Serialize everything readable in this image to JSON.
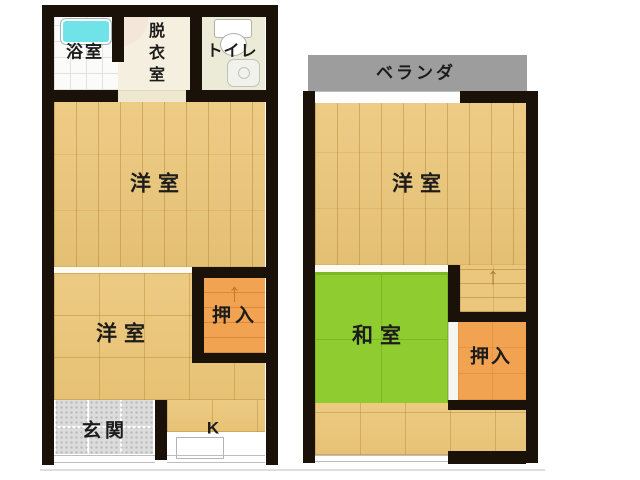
{
  "colors": {
    "wall": "#1a1208",
    "wood": "#ebc678",
    "wood_line": "#d7af5f",
    "orange": "#f1a351",
    "orange_line": "#d88a39",
    "tatami": "#8ecc2f",
    "tatami_line": "#7bb824",
    "balcony": "#9d9d9d",
    "bathtub": "#6fe3e7",
    "tile": "#dcdcdc",
    "toilet_floor": "#ebebd8",
    "dressing_floor": "#f4efdf",
    "label": "#1c1c1c"
  },
  "floor1": {
    "bath": "浴室",
    "dressing": "脱衣室",
    "toilet": "トイレ",
    "room_large": "洋室",
    "room_small": "洋室",
    "closet": "押入",
    "entrance": "玄関",
    "kitchen": "K",
    "stairs_arrow": "↑"
  },
  "floor2": {
    "balcony": "ベランダ",
    "room": "洋室",
    "tatami_room": "和室",
    "closet": "押入",
    "stairs_arrow": "↑"
  }
}
